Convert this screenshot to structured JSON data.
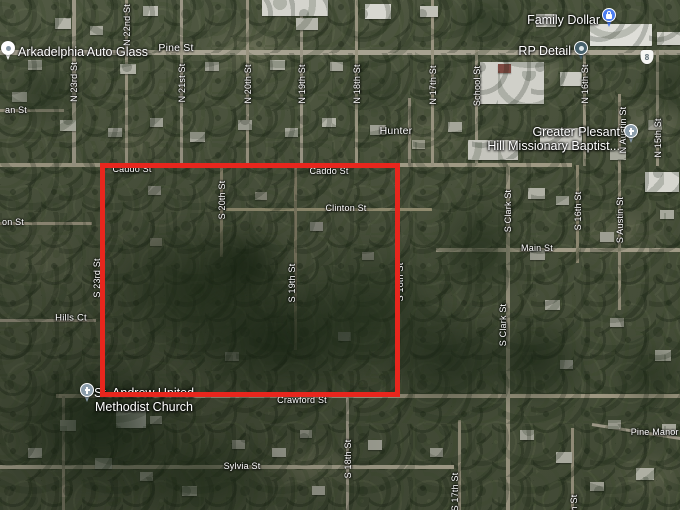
{
  "map": {
    "selection_overlay": {
      "x": 100,
      "y": 163,
      "width": 300,
      "height": 234,
      "thickness": 5,
      "color": "#e8261d"
    },
    "highway_shield": {
      "number": "8",
      "x": 647,
      "y": 57
    },
    "street_labels": [
      {
        "text": "Pine St",
        "x": 176,
        "y": 48,
        "vertical": false,
        "size": 10.5
      },
      {
        "text": "an St",
        "x": 16,
        "y": 110,
        "vertical": false
      },
      {
        "text": "N 23rd St",
        "x": 74,
        "y": 82,
        "vertical": true
      },
      {
        "text": "N 22nd St",
        "x": 127,
        "y": 25,
        "vertical": true
      },
      {
        "text": "N 21st St",
        "x": 182,
        "y": 83,
        "vertical": true
      },
      {
        "text": "N 20th St",
        "x": 248,
        "y": 84,
        "vertical": true
      },
      {
        "text": "N 19th St",
        "x": 302,
        "y": 84,
        "vertical": true
      },
      {
        "text": "N 18th St",
        "x": 357,
        "y": 84,
        "vertical": true
      },
      {
        "text": "N 17th St",
        "x": 433,
        "y": 85,
        "vertical": true
      },
      {
        "text": "School St",
        "x": 477,
        "y": 86,
        "vertical": true
      },
      {
        "text": "N 16th St",
        "x": 585,
        "y": 84,
        "vertical": true
      },
      {
        "text": "N Austin St",
        "x": 623,
        "y": 130,
        "vertical": true
      },
      {
        "text": "N 15th St",
        "x": 658,
        "y": 138,
        "vertical": true
      },
      {
        "text": "Hunter",
        "x": 396,
        "y": 131,
        "vertical": false,
        "size": 10.5
      },
      {
        "text": "Caddo St",
        "x": 132,
        "y": 169,
        "vertical": false
      },
      {
        "text": "Caddo St",
        "x": 329,
        "y": 171,
        "vertical": false
      },
      {
        "text": "Clinton St",
        "x": 346,
        "y": 208,
        "vertical": false
      },
      {
        "text": "S 20th St",
        "x": 222,
        "y": 200,
        "vertical": true
      },
      {
        "text": "on St",
        "x": 13,
        "y": 222,
        "vertical": false
      },
      {
        "text": "S 23rd St",
        "x": 97,
        "y": 278,
        "vertical": true
      },
      {
        "text": "S 19th St",
        "x": 292,
        "y": 283,
        "vertical": true
      },
      {
        "text": "S Clark St",
        "x": 508,
        "y": 211,
        "vertical": true
      },
      {
        "text": "S 16th St",
        "x": 578,
        "y": 211,
        "vertical": true
      },
      {
        "text": "S Austin St",
        "x": 620,
        "y": 220,
        "vertical": true
      },
      {
        "text": "Main St",
        "x": 537,
        "y": 248,
        "vertical": false
      },
      {
        "text": "Hills Ct",
        "x": 71,
        "y": 318,
        "vertical": false,
        "size": 9.5
      },
      {
        "text": "S Clark St",
        "x": 503,
        "y": 325,
        "vertical": true
      },
      {
        "text": "S 18th St",
        "x": 400,
        "y": 282,
        "vertical": true
      },
      {
        "text": "Crawford St",
        "x": 302,
        "y": 400,
        "vertical": false
      },
      {
        "text": "Sylvia St",
        "x": 242,
        "y": 466,
        "vertical": false
      },
      {
        "text": "S 18th St",
        "x": 348,
        "y": 459,
        "vertical": true
      },
      {
        "text": "S 17th St",
        "x": 455,
        "y": 492,
        "vertical": true
      },
      {
        "text": "S 15th St",
        "x": 574,
        "y": 514,
        "vertical": true
      },
      {
        "text": "Pine Manor Dr",
        "x": 661,
        "y": 432,
        "vertical": false
      }
    ],
    "pois": [
      {
        "id": "arkadelphia-auto-glass",
        "lines": [
          "Arkadelphia Auto Glass"
        ],
        "pin": "generic",
        "pin_x": 8,
        "pin_y": 48,
        "label_x": 18,
        "label_y": 52,
        "align": "left"
      },
      {
        "id": "family-dollar",
        "lines": [
          "Family Dollar"
        ],
        "pin": "shop",
        "pin_x": 609,
        "pin_y": 15,
        "label_x": 600,
        "label_y": 20,
        "align": "right"
      },
      {
        "id": "rp-detail",
        "lines": [
          "RP Detail"
        ],
        "pin": "detail",
        "pin_x": 581,
        "pin_y": 48,
        "label_x": 571,
        "label_y": 51,
        "align": "right"
      },
      {
        "id": "greater-plesant-hill-missionary-baptist",
        "lines": [
          "Greater Plesant",
          "Hill Missionary Baptist..."
        ],
        "pin": "church",
        "pin_x": 631,
        "pin_y": 131,
        "label_x": 620,
        "label_y": 139,
        "align": "right"
      },
      {
        "id": "st-andrew-united-methodist-church",
        "lines": [
          "St. Andrew United",
          "Methodist Church"
        ],
        "pin": "church",
        "pin_x": 87,
        "pin_y": 390,
        "label_x": 144,
        "label_y": 400,
        "align": "center"
      }
    ],
    "pin_colors": {
      "generic": "#ffffff",
      "generic_dot": "#8495a3",
      "shop": "#4b7df2",
      "detail": "#46616c",
      "detail_dot": "#dce6e9",
      "church": "#8b9dab"
    }
  }
}
